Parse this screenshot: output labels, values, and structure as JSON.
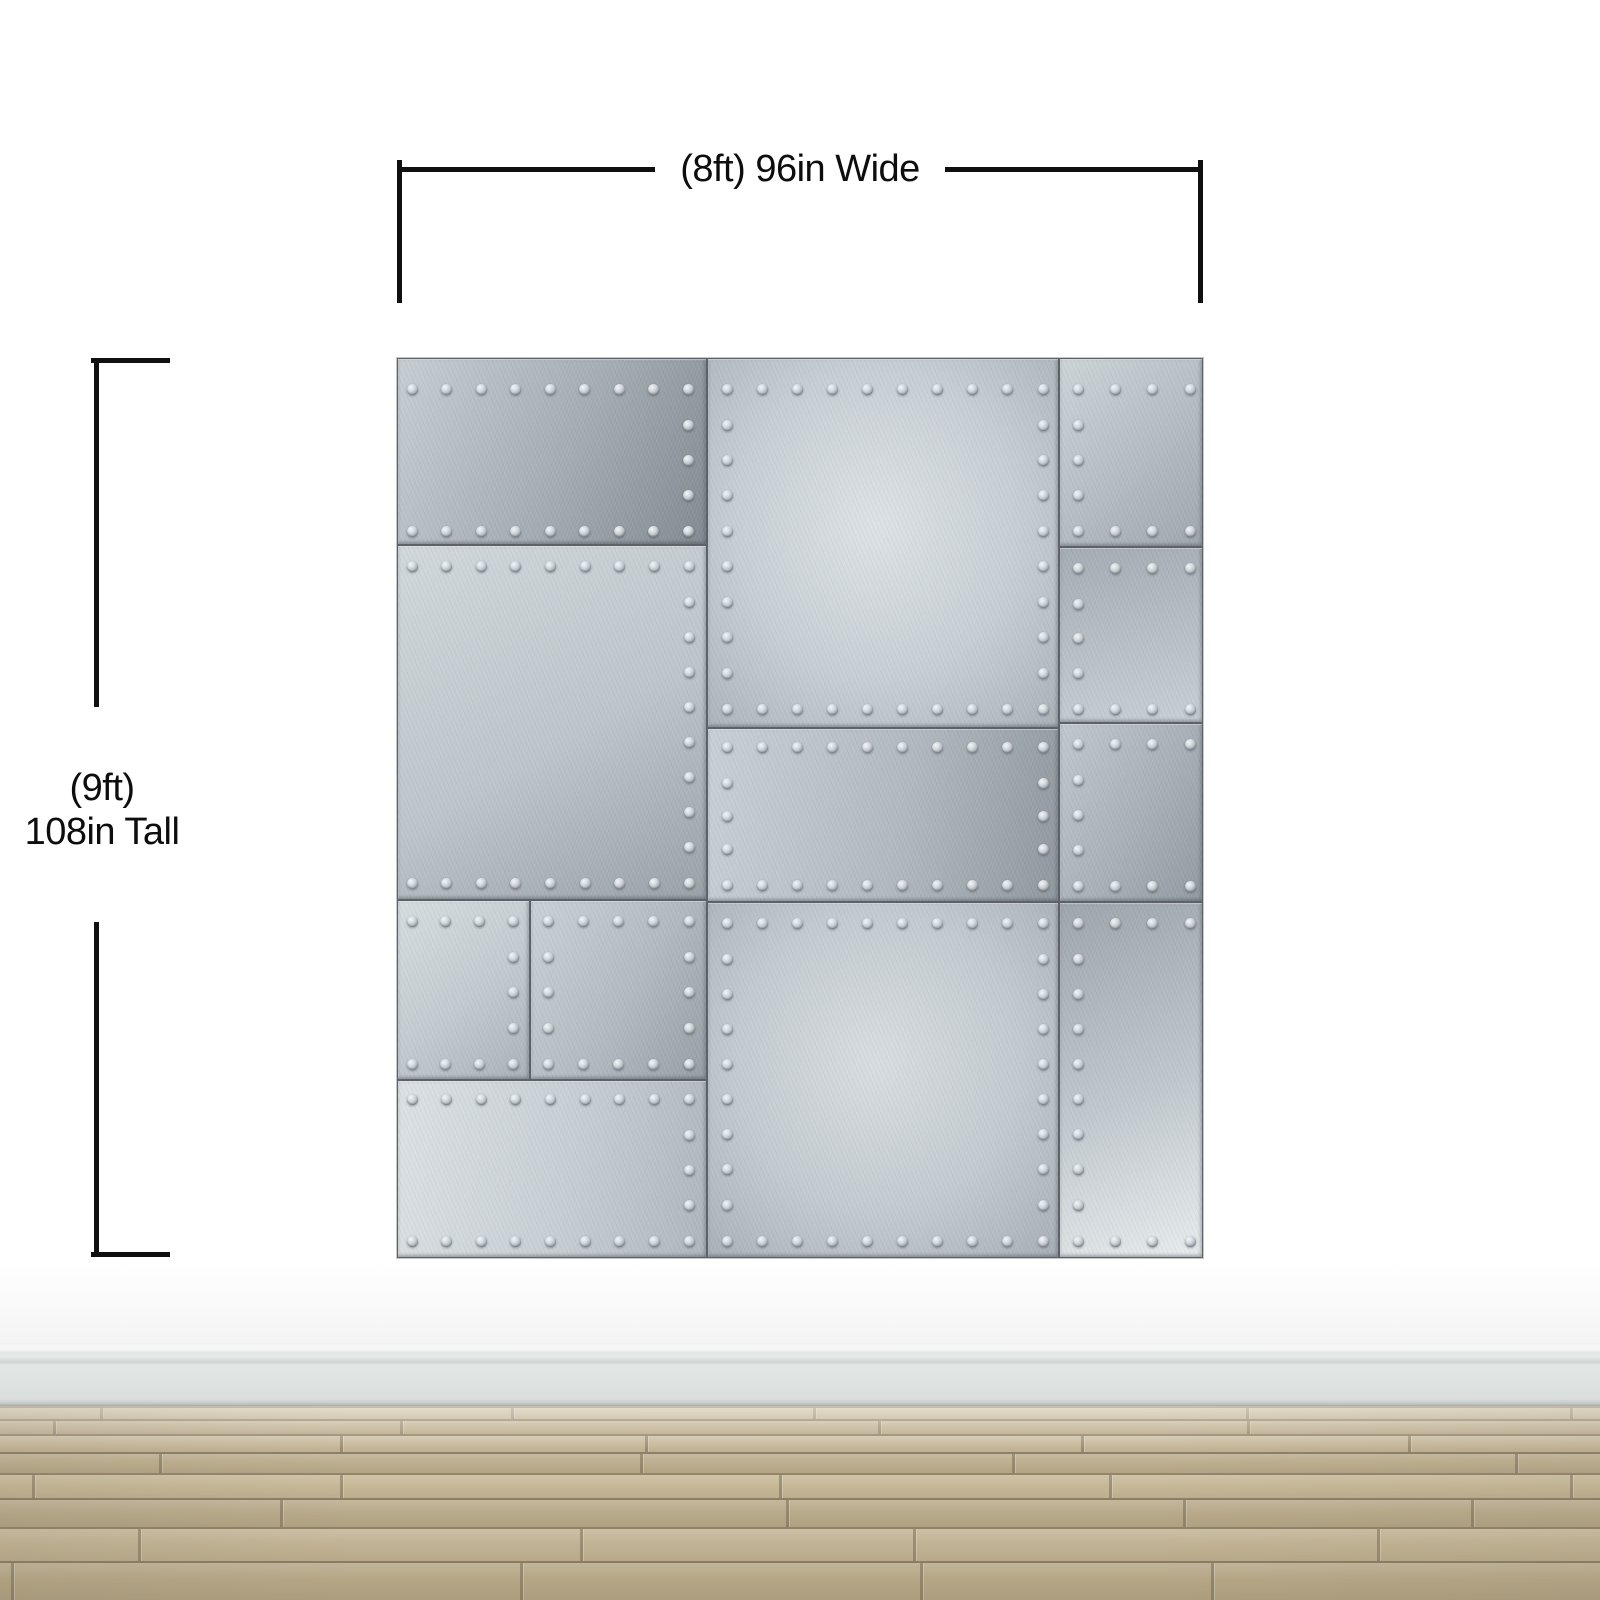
{
  "annotations": {
    "width_label": "(8ft) 96in Wide",
    "height_label_line1": "(9ft)",
    "height_label_line2": "108in Tall",
    "line_color": "#101010"
  },
  "mural": {
    "description": "riveted brushed-metal plates wall mural",
    "seam_color": "#5c6268",
    "rivet": {
      "size": 11,
      "pitch": 36,
      "edge_inset": 14
    },
    "plates": [
      {
        "id": "L1",
        "x": 0,
        "y": 0,
        "w": 310,
        "h": 187,
        "angle": 115,
        "stops": [
          "#c6ced3",
          "#a4acb3",
          "#828a92"
        ],
        "rivets": {
          "top": 30,
          "bottom": 15,
          "right": 20
        }
      },
      {
        "id": "L2",
        "x": 0,
        "y": 187,
        "w": 310,
        "h": 355,
        "angle": 150,
        "stops": [
          "#d1d8dc",
          "#bdc5ca",
          "#99a1a9"
        ],
        "rivets": {
          "top": 20,
          "bottom": 18,
          "right": 19
        }
      },
      {
        "id": "L3a",
        "x": 0,
        "y": 542,
        "w": 133,
        "h": 180,
        "angle": 140,
        "stops": [
          "#d6dde0",
          "#c2cacf",
          "#aab2b9"
        ],
        "rivets": {
          "top": 20,
          "bottom": 17,
          "right": 18
        }
      },
      {
        "id": "L3b",
        "x": 133,
        "y": 542,
        "w": 177,
        "h": 180,
        "angle": 120,
        "stops": [
          "#cad1d6",
          "#b2bac1",
          "#969ea6"
        ],
        "rivets": {
          "top": 20,
          "bottom": 17,
          "left": 17,
          "right": 19
        }
      },
      {
        "id": "L4",
        "x": 0,
        "y": 722,
        "w": 310,
        "h": 178,
        "angle": 100,
        "stops": [
          "#dbe1e4",
          "#c7ced3",
          "#aeb6bd"
        ],
        "rivets": {
          "top": 18,
          "bottom": 18,
          "right": 19
        }
      },
      {
        "id": "M1",
        "x": 310,
        "y": 0,
        "w": 352,
        "h": 370,
        "radial": true,
        "stops": [
          "#dce2e5",
          "#c7ced3",
          "#a9b1b8"
        ],
        "rivets": {
          "top": 30,
          "bottom": 20,
          "left": 19,
          "right": 17
        }
      },
      {
        "id": "M2",
        "x": 310,
        "y": 370,
        "w": 352,
        "h": 174,
        "angle": 100,
        "stops": [
          "#c9d0d5",
          "#b1b9c0",
          "#8f979f"
        ],
        "rivets": {
          "top": 18,
          "bottom": 18,
          "left": 19,
          "right": 17
        }
      },
      {
        "id": "M3",
        "x": 310,
        "y": 544,
        "w": 352,
        "h": 356,
        "radial": true,
        "stops": [
          "#d7dde0",
          "#c3cacf",
          "#a6aeb5"
        ],
        "rivets": {
          "top": 20,
          "bottom": 18,
          "left": 19,
          "right": 17
        }
      },
      {
        "id": "R1",
        "x": 662,
        "y": 0,
        "w": 144,
        "h": 189,
        "angle": 135,
        "stops": [
          "#cdd4d8",
          "#b4bcc2",
          "#9fa7af"
        ],
        "rivets": {
          "top": 30,
          "bottom": 17,
          "left": 18
        }
      },
      {
        "id": "R2",
        "x": 662,
        "y": 189,
        "w": 144,
        "h": 176,
        "angle": 170,
        "stops": [
          "#a4acb4",
          "#b8c0c6",
          "#c8cfd4"
        ],
        "rivets": {
          "top": 20,
          "bottom": 15,
          "left": 18
        }
      },
      {
        "id": "R3",
        "x": 662,
        "y": 365,
        "w": 144,
        "h": 179,
        "angle": 120,
        "stops": [
          "#c0c8cd",
          "#a8b0b7",
          "#929aa2"
        ],
        "rivets": {
          "top": 20,
          "bottom": 17,
          "left": 18
        }
      },
      {
        "id": "R4",
        "x": 662,
        "y": 544,
        "w": 144,
        "h": 356,
        "angle": 160,
        "stops": [
          "#9da5ad",
          "#c1c8cd",
          "#e7eced"
        ],
        "rivets": {
          "top": 20,
          "bottom": 18,
          "left": 18
        }
      }
    ]
  },
  "room": {
    "wall_color": "#ffffff",
    "baseboard_color": "#dfe4e2",
    "floor": {
      "seam_color": "rgba(104,92,70,0.5)",
      "rows": [
        {
          "h": 13,
          "c": "#cdbfa2"
        },
        {
          "h": 15,
          "c": "#c3b494"
        },
        {
          "h": 18,
          "c": "#cabb9d"
        },
        {
          "h": 21,
          "c": "#bdae8f"
        },
        {
          "h": 25,
          "c": "#c7b898"
        },
        {
          "h": 29,
          "c": "#b9aa8b"
        },
        {
          "h": 34,
          "c": "#c2b394"
        },
        {
          "h": 39,
          "c": "#b5a686"
        }
      ]
    }
  }
}
